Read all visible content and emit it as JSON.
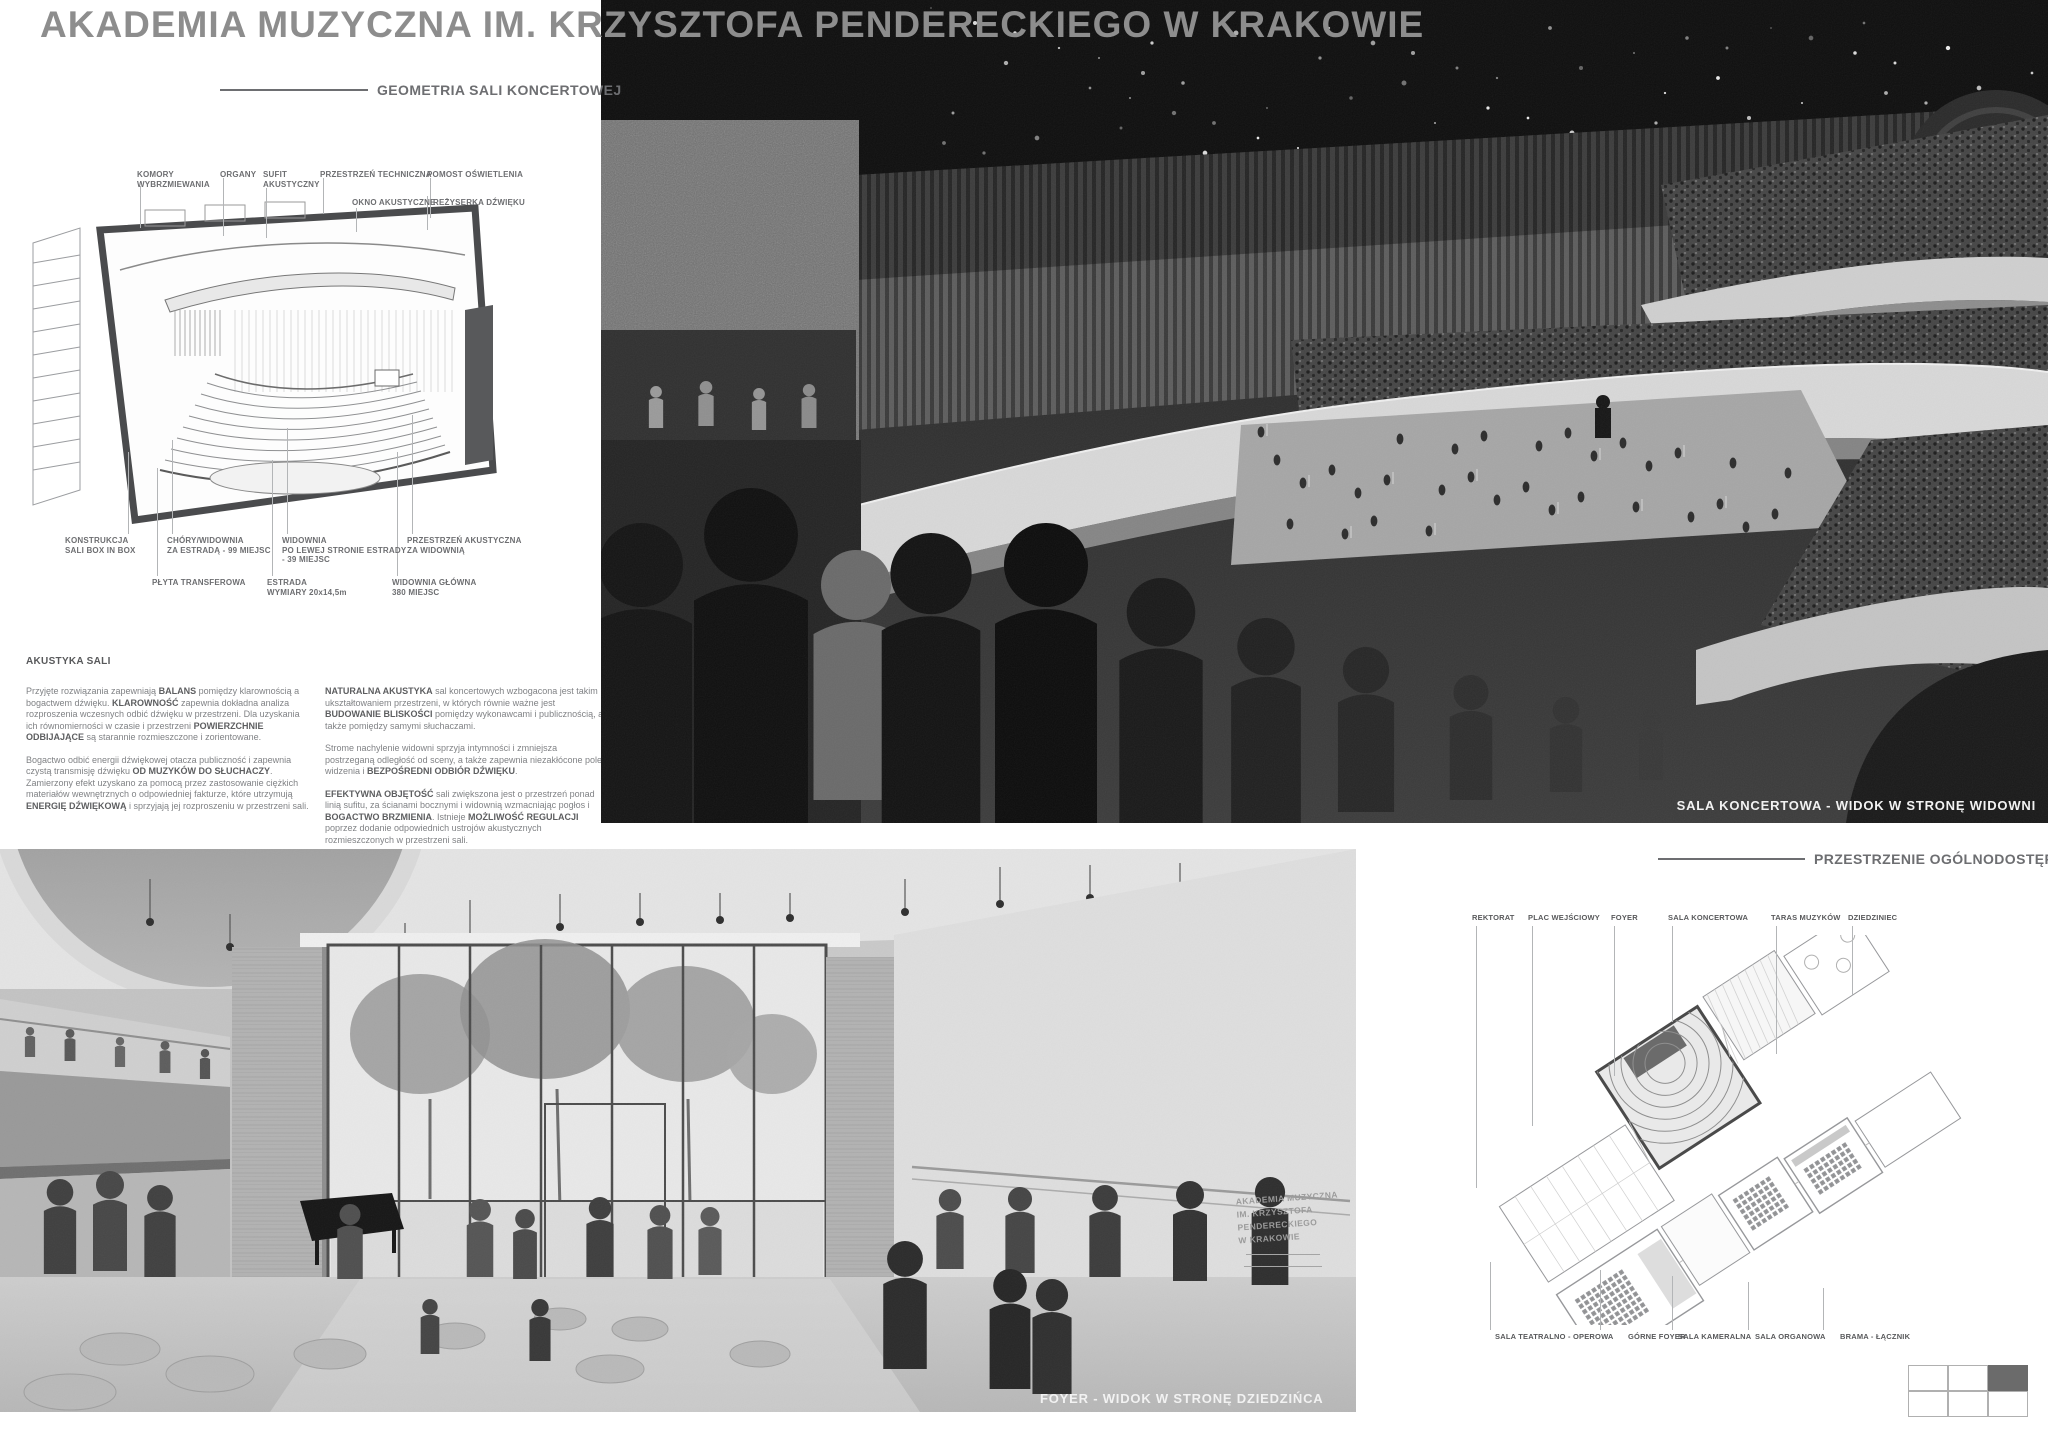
{
  "title": "AKADEMIA MUZYCZNA IM. KRZYSZTOFA PENDERECKIEGO W KRAKOWIE",
  "geometry_section": {
    "heading": "GEOMETRIA SALI KONCERTOWEJ",
    "callouts_top": [
      "KOMORY\nWYBRZMIEWANIA",
      "ORGANY",
      "SUFIT\nAKUSTYCZNY",
      "PRZESTRZEŃ TECHNICZNA",
      "POMOST OŚWIETLENIA",
      "OKNO AKUSTYCZNE",
      "REŻYSERKA DŹWIĘKU"
    ],
    "callouts_bottom": [
      "KONSTRUKCJA\nSALI BOX IN BOX",
      "CHÓRY/WIDOWNIA\nZA ESTRADĄ - 99 MIEJSC",
      "WIDOWNIA\nPO LEWEJ STRONIE ESTRADY\n- 39 MIEJSC",
      "PRZESTRZEŃ AKUSTYCZNA\nZA WIDOWNIĄ",
      "PŁYTA TRANSFEROWA",
      "ESTRADA\nWYMIARY 20x14,5m",
      "WIDOWNIA GŁÓWNA\n380 MIEJSC"
    ]
  },
  "acoustics": {
    "heading": "AKUSTYKA SALI",
    "col1": [
      [
        {
          "t": "Przyjęte rozwiązania zapewniają "
        },
        {
          "t": "BALANS",
          "b": true
        },
        {
          "t": " pomiędzy klarownością a bogactwem dźwięku. "
        },
        {
          "t": "KLAROWNOŚĆ",
          "b": true
        },
        {
          "t": " zapewnia dokładna analiza rozproszenia wczesnych odbić dźwięku w przestrzeni. Dla uzyskania ich równomierności w czasie i przestrzeni "
        },
        {
          "t": "POWIERZCHNIE ODBIJAJĄCE",
          "b": true
        },
        {
          "t": " są starannie rozmieszczone i zorientowane."
        }
      ],
      [
        {
          "t": "Bogactwo odbić energii dźwiękowej otacza publiczność i zapewnia czystą transmisję dźwięku "
        },
        {
          "t": "OD MUZYKÓW DO SŁUCHACZY",
          "b": true
        },
        {
          "t": ". Zamierzony efekt uzyskano za pomocą przez zastosowanie ciężkich materiałów wewnętrznych o odpowiedniej fakturze, które utrzymują "
        },
        {
          "t": "ENERGIĘ DŹWIĘKOWĄ",
          "b": true
        },
        {
          "t": " i sprzyjają jej rozproszeniu w przestrzeni sali."
        }
      ]
    ],
    "col2": [
      [
        {
          "t": "NATURALNA AKUSTYKA",
          "b": true
        },
        {
          "t": " sal koncertowych wzbogacona jest takim ukształtowaniem przestrzeni, w których równie ważne jest "
        },
        {
          "t": "BUDOWANIE BLISKOŚCI",
          "b": true
        },
        {
          "t": " pomiędzy wykonawcami i publicznością, a także pomiędzy samymi słuchaczami."
        }
      ],
      [
        {
          "t": "Strome nachylenie widowni sprzyja intymności i zmniejsza postrzeganą odległość od sceny, a także zapewnia niezakłócone pole widzenia i "
        },
        {
          "t": "BEZPOŚREDNI ODBIÓR DŹWIĘKU",
          "b": true
        },
        {
          "t": "."
        }
      ],
      [
        {
          "t": "EFEKTYWNA OBJĘTOŚĆ",
          "b": true
        },
        {
          "t": " sali zwiększona jest o przestrzeń ponad linią sufitu, za ścianami bocznymi i widownią wzmacniając pogłos i "
        },
        {
          "t": "BOGACTWO BRZMIENIA",
          "b": true
        },
        {
          "t": ". Istnieje "
        },
        {
          "t": "MOŻLIWOŚĆ REGULACJI",
          "b": true
        },
        {
          "t": " poprzez dodanie odpowiednich ustrojów akustycznych rozmieszczonych w przestrzeni sali."
        }
      ]
    ]
  },
  "hall_photo": {
    "caption": "SALA KONCERTOWA - WIDOK W STRONĘ WIDOWNI"
  },
  "foyer_photo": {
    "caption": "FOYER - WIDOK W STRONĘ DZIEDZIŃCA",
    "wall_sign": "AKADEMIA MUZYCZNA\nIM. KRZYSZTOFA\nPENDERECKIEGO\nW KRAKOWIE"
  },
  "public_section": {
    "heading": "PRZESTRZENIE OGÓLNODOSTĘPNE",
    "labels_top": [
      "REKTORAT",
      "PLAC WEJŚCIOWY",
      "FOYER",
      "SALA KONCERTOWA",
      "TARAS MUZYKÓW",
      "DZIEDZINIEC"
    ],
    "labels_bottom": [
      "SALA TEATRALNO - OPEROWA",
      "GÓRNE FOYER",
      "SALA KAMERALNA",
      "SALA ORGANOWA",
      "BRAMA - ŁĄCZNIK"
    ]
  },
  "page_indicator": {
    "rows": 2,
    "cols": 3,
    "active_cell": "top-right"
  },
  "colors": {
    "title_gray": "#8d8d8d",
    "heading_gray": "#6d6e71",
    "label_gray": "#58595b",
    "body_gray": "#808285",
    "leader_gray": "#b3b5b7",
    "active_cell": "#6b6b6b"
  }
}
